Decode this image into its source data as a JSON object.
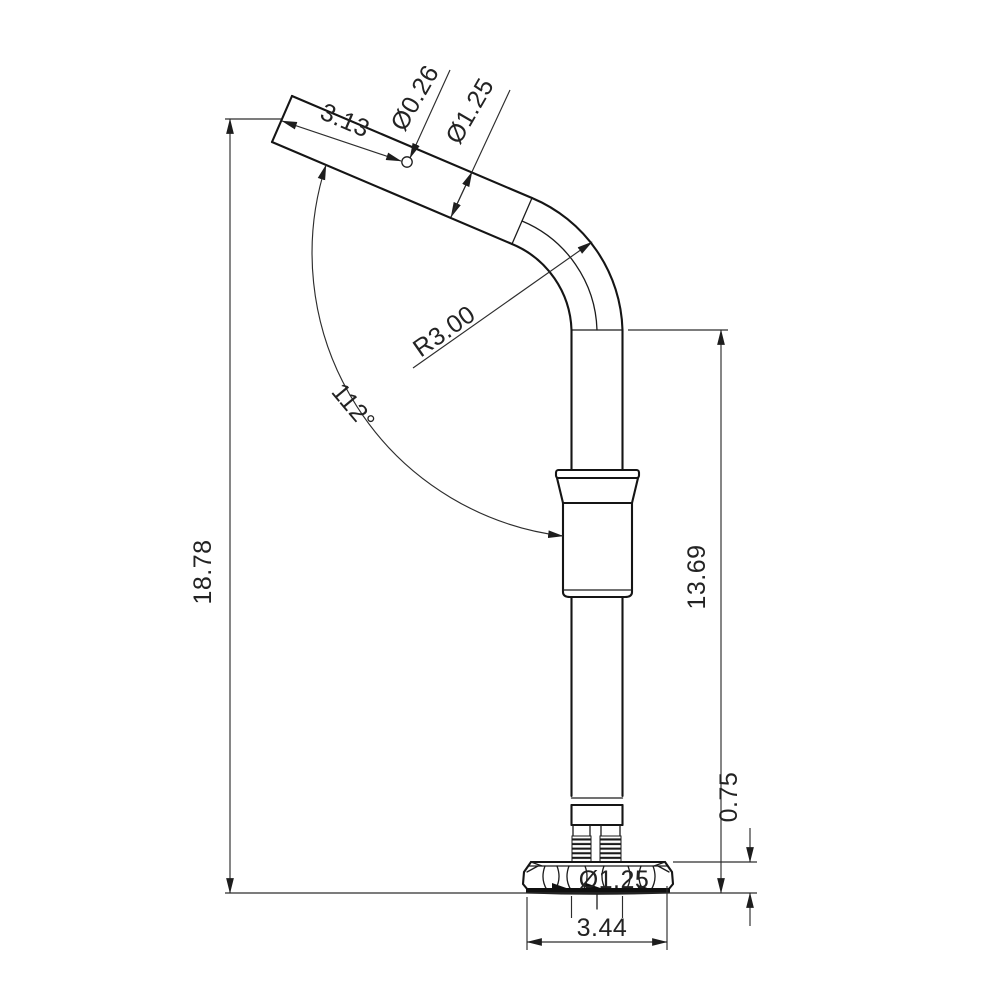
{
  "drawing": {
    "kind": "technical-dimension-drawing",
    "subject": "bent tube pole with adjuster sleeve, threaded studs and fluted round base",
    "background": "#ffffff",
    "line_color": "#151515",
    "dim_color": "#2d2d2d",
    "dimensions": {
      "arm_hole_offset": "3.13",
      "arm_hole_dia": "Ø0.26",
      "tube_dia": "Ø1.25",
      "bend_radius": "R3.00",
      "bend_angle": "112°",
      "overall_height": "18.78",
      "post_height": "13.69",
      "base_height": "0.75",
      "base_hole_dia": "Ø1.25",
      "base_width": "3.44"
    }
  }
}
